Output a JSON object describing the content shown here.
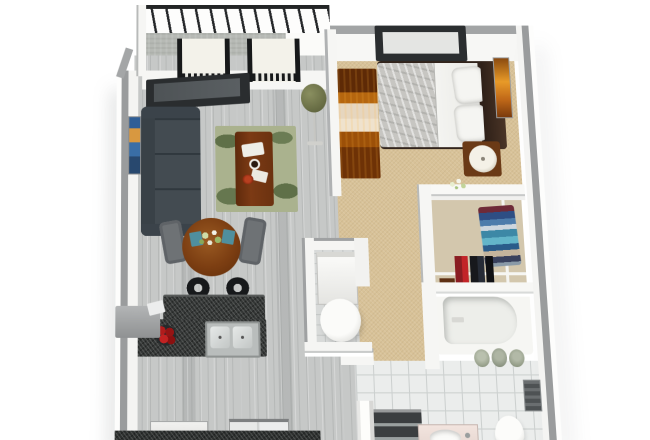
{
  "meta": {
    "type": "3d-floorplan-render",
    "description": "Top-down 3D render of a one-bedroom apartment floor plan on a white background",
    "visible_text": "none"
  },
  "palette": {
    "background": "#ffffff",
    "wall_cap_gray": "#9a9c9d",
    "wall_face_white": "#f6f6f4",
    "wood_floor": "#c6c8c7",
    "carpet_beige": "#d8c298",
    "bath_tile": "#ebedec",
    "balcony_concrete": "#b6b9b4",
    "granite_counter": "#343736",
    "sofa_charcoal": "#434b51",
    "table_wood": "#7c3e12",
    "rug_green": "#aab28e",
    "apples_red": "#b01c1c",
    "plant_olive": "#6b7047",
    "railing_black": "#232526",
    "dresser_orange": "#b5660f",
    "headboard_brown": "#32241c"
  },
  "labels": {
    "plan": "One-bedroom apartment 3D floor plan",
    "balcony": "Balcony",
    "railing": "Balcony railing",
    "lounge_chair": "Lounge chair",
    "plant": "Potted plant on stand",
    "living_window": "Living room window",
    "sofa": "Sectional sofa",
    "wall_art_living": "Wall art",
    "rug": "Area rug",
    "coffee_table": "Coffee table",
    "dining_table": "Round dining table",
    "dining_chair": "Dining chair",
    "centerpiece": "Flower centerpiece",
    "bar_stool": "Bar stool",
    "island_bar": "Breakfast bar counter",
    "island_counter": "Island counter with sink",
    "sink": "Double kitchen sink",
    "fruit_bowl": "Bowl of red apples",
    "kitchen_cabinet": "Kitchen cabinet",
    "range": "Range with burners",
    "refrigerator": "Refrigerator",
    "base_counter": "Kitchen base counter",
    "bedroom_window": "Bedroom window",
    "bed": "Double bed",
    "blanket": "Gray blanket",
    "duvet": "White duvet",
    "pillow": "Pillow",
    "headboard": "Headboard",
    "dresser": "Wood dresser",
    "nightstand": "Nightstand",
    "lamp": "Table lamp",
    "wall_art_bedroom": "Wall art",
    "closet": "Walk-in closet",
    "closet_shelf": "Closet shelf post",
    "closet_rod": "Closet hanging rod",
    "folded_clothes": "Folded clothes stack",
    "hanging_clothes": "Hanging clothes",
    "storage_box": "Storage box",
    "closet_flowers": "Flowers on half wall",
    "washer": "Washer",
    "water_heater": "Water heater",
    "bathtub": "Bathtub",
    "towels": "Rolled towels",
    "towel_rack": "Towel rack",
    "bath_cabinet": "Bathroom cabinet",
    "vanity": "Vanity sink",
    "toilet": "Toilet"
  },
  "rooms": [
    {
      "name": "balcony",
      "items": [
        "railing",
        "lounge chair",
        "lounge chair"
      ]
    },
    {
      "name": "living-room",
      "items": [
        "sectional sofa",
        "area rug",
        "coffee table",
        "wall art",
        "window",
        "potted plant"
      ]
    },
    {
      "name": "dining-area",
      "items": [
        "round table",
        "2 chairs",
        "flower centerpiece"
      ]
    },
    {
      "name": "kitchen",
      "items": [
        "island with double sink",
        "breakfast bar",
        "2 bar stools",
        "fruit bowl",
        "cabinet",
        "range",
        "refrigerator"
      ]
    },
    {
      "name": "bedroom",
      "items": [
        "double bed",
        "headboard",
        "2 pillows",
        "dresser",
        "nightstand",
        "lamp",
        "wall art",
        "window"
      ]
    },
    {
      "name": "closet",
      "items": [
        "folded clothes",
        "hanging clothes",
        "rod",
        "shelf",
        "storage box"
      ]
    },
    {
      "name": "utility-closet",
      "items": [
        "washer",
        "water heater"
      ]
    },
    {
      "name": "hallway",
      "items": []
    },
    {
      "name": "bathroom",
      "items": [
        "bathtub",
        "rolled towels",
        "towel rack",
        "cabinet",
        "vanity sink",
        "toilet"
      ]
    }
  ]
}
